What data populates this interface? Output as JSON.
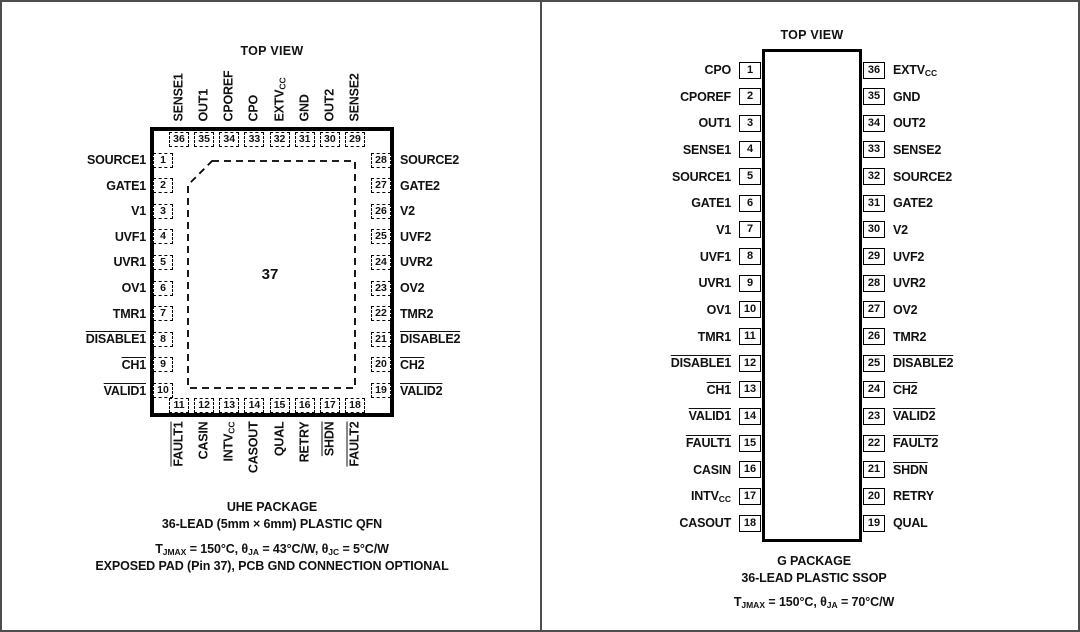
{
  "left_panel": {
    "top_view": "TOP VIEW",
    "center_pin": "37",
    "pins_top": [
      {
        "n": "36",
        "label": "SENSE1"
      },
      {
        "n": "35",
        "label": "OUT1"
      },
      {
        "n": "34",
        "label": "CPOREF"
      },
      {
        "n": "33",
        "label": "CPO"
      },
      {
        "n": "32",
        "label": "EXTV",
        "sub": "CC"
      },
      {
        "n": "31",
        "label": "GND"
      },
      {
        "n": "30",
        "label": "OUT2"
      },
      {
        "n": "29",
        "label": "SENSE2"
      }
    ],
    "pins_left": [
      {
        "n": "1",
        "label": "SOURCE1"
      },
      {
        "n": "2",
        "label": "GATE1"
      },
      {
        "n": "3",
        "label": "V1"
      },
      {
        "n": "4",
        "label": "UVF1"
      },
      {
        "n": "5",
        "label": "UVR1"
      },
      {
        "n": "6",
        "label": "OV1"
      },
      {
        "n": "7",
        "label": "TMR1"
      },
      {
        "n": "8",
        "label": "DISABLE1",
        "bar": true
      },
      {
        "n": "9",
        "label": "CH1",
        "bar": true
      },
      {
        "n": "10",
        "label": "VALID1",
        "bar": true
      }
    ],
    "pins_right": [
      {
        "n": "28",
        "label": "SOURCE2"
      },
      {
        "n": "27",
        "label": "GATE2"
      },
      {
        "n": "26",
        "label": "V2"
      },
      {
        "n": "25",
        "label": "UVF2"
      },
      {
        "n": "24",
        "label": "UVR2"
      },
      {
        "n": "23",
        "label": "OV2"
      },
      {
        "n": "22",
        "label": "TMR2"
      },
      {
        "n": "21",
        "label": "DISABLE2",
        "bar": true
      },
      {
        "n": "20",
        "label": "CH2",
        "bar": true
      },
      {
        "n": "19",
        "label": "VALID2",
        "bar": true
      }
    ],
    "pins_bottom": [
      {
        "n": "11",
        "label": "FAULT1",
        "bar": true
      },
      {
        "n": "12",
        "label": "CASIN"
      },
      {
        "n": "13",
        "label": "INTV",
        "sub": "CC"
      },
      {
        "n": "14",
        "label": "CASOUT"
      },
      {
        "n": "15",
        "label": "QUAL"
      },
      {
        "n": "16",
        "label": "RETRY"
      },
      {
        "n": "17",
        "label": "SHDN",
        "bar": true
      },
      {
        "n": "18",
        "label": "FAULT2",
        "bar": true
      }
    ],
    "package_name": [
      "UHE PACKAGE",
      "36-LEAD (5mm × 6mm) PLASTIC QFN"
    ],
    "thermal_note": [
      [
        {
          "t": "T"
        },
        {
          "s": "JMAX"
        },
        {
          "t": " = 150°C, θ"
        },
        {
          "s": "JA"
        },
        {
          "t": " = 43°C/W, θ"
        },
        {
          "s": "JC"
        },
        {
          "t": " = 5°C/W"
        }
      ],
      [
        {
          "t": "EXPOSED PAD (Pin 37), PCB GND CONNECTION OPTIONAL"
        }
      ]
    ]
  },
  "right_panel": {
    "top_view": "TOP VIEW",
    "pins_left": [
      {
        "n": "1",
        "label": "CPO"
      },
      {
        "n": "2",
        "label": "CPOREF"
      },
      {
        "n": "3",
        "label": "OUT1"
      },
      {
        "n": "4",
        "label": "SENSE1"
      },
      {
        "n": "5",
        "label": "SOURCE1"
      },
      {
        "n": "6",
        "label": "GATE1"
      },
      {
        "n": "7",
        "label": "V1"
      },
      {
        "n": "8",
        "label": "UVF1"
      },
      {
        "n": "9",
        "label": "UVR1"
      },
      {
        "n": "10",
        "label": "OV1"
      },
      {
        "n": "11",
        "label": "TMR1"
      },
      {
        "n": "12",
        "label": "DISABLE1",
        "bar": true
      },
      {
        "n": "13",
        "label": "CH1",
        "bar": true
      },
      {
        "n": "14",
        "label": "VALID1",
        "bar": true
      },
      {
        "n": "15",
        "label": "FAULT1",
        "bar": true
      },
      {
        "n": "16",
        "label": "CASIN"
      },
      {
        "n": "17",
        "label": "INTV",
        "sub": "CC"
      },
      {
        "n": "18",
        "label": "CASOUT"
      }
    ],
    "pins_right": [
      {
        "n": "36",
        "label": "EXTV",
        "sub": "CC"
      },
      {
        "n": "35",
        "label": "GND"
      },
      {
        "n": "34",
        "label": "OUT2"
      },
      {
        "n": "33",
        "label": "SENSE2"
      },
      {
        "n": "32",
        "label": "SOURCE2"
      },
      {
        "n": "31",
        "label": "GATE2"
      },
      {
        "n": "30",
        "label": "V2"
      },
      {
        "n": "29",
        "label": "UVF2"
      },
      {
        "n": "28",
        "label": "UVR2"
      },
      {
        "n": "27",
        "label": "OV2"
      },
      {
        "n": "26",
        "label": "TMR2"
      },
      {
        "n": "25",
        "label": "DISABLE2",
        "bar": true
      },
      {
        "n": "24",
        "label": "CH2",
        "bar": true
      },
      {
        "n": "23",
        "label": "VALID2",
        "bar": true
      },
      {
        "n": "22",
        "label": "FAULT2",
        "bar": true
      },
      {
        "n": "21",
        "label": "SHDN",
        "bar": true
      },
      {
        "n": "20",
        "label": "RETRY"
      },
      {
        "n": "19",
        "label": "QUAL"
      }
    ],
    "package_name": [
      "G PACKAGE",
      "36-LEAD PLASTIC SSOP"
    ],
    "thermal_note": [
      [
        {
          "t": "T"
        },
        {
          "s": "JMAX"
        },
        {
          "t": " = 150°C, θ"
        },
        {
          "s": "JA"
        },
        {
          "t": " = 70°C/W"
        }
      ]
    ]
  }
}
